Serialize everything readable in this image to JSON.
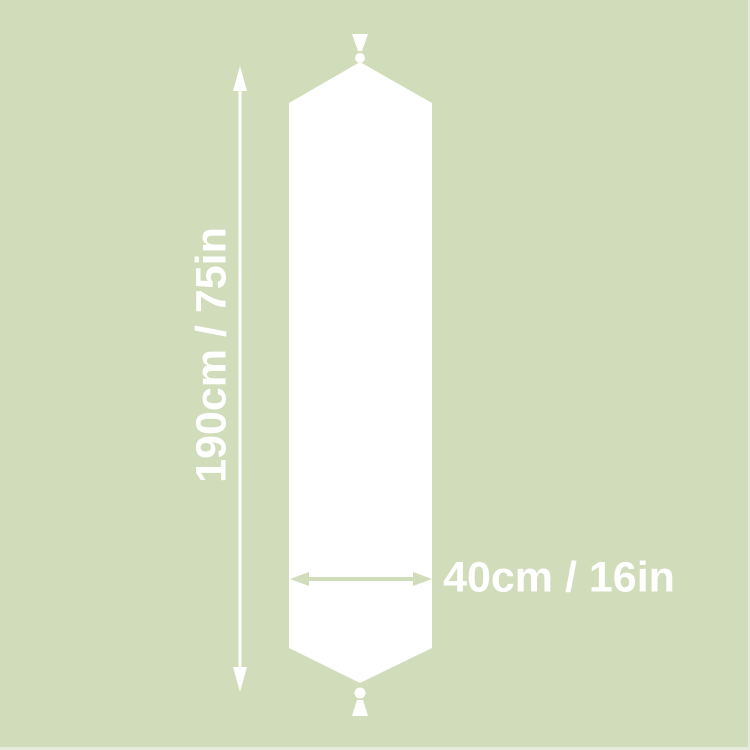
{
  "diagram": {
    "title": "table-runner-dimension-diagram",
    "length_label": "190cm / 75in",
    "width_label": "40cm / 16in",
    "colors": {
      "background": "#d1dcba",
      "runner": "#ffffff",
      "dimension_lines": "#ffffff",
      "width_arrow": "#d1dcba",
      "label_text": "#ffffff"
    }
  }
}
